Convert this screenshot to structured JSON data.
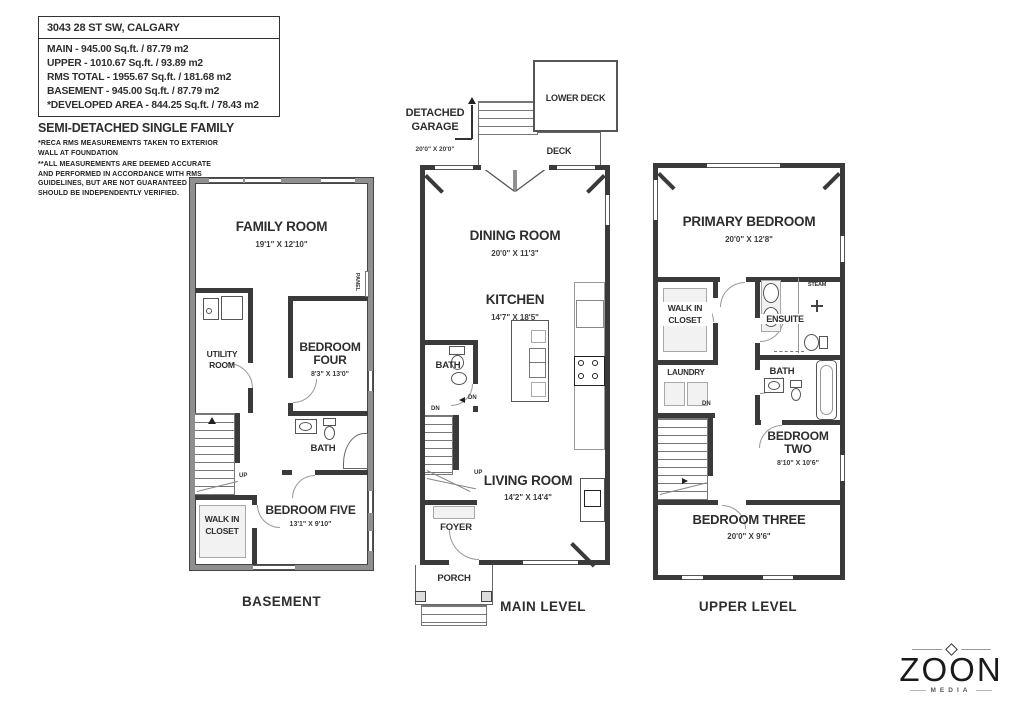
{
  "colors": {
    "wall": "#3a3a3a",
    "foundation": "#8f8f8f",
    "text": "#2e2e2e",
    "logo": "#1a1a1a"
  },
  "header": {
    "address": "3043 28 ST SW, CALGARY",
    "area_lines": [
      "MAIN - 945.00 Sq.ft. / 87.79 m2",
      "UPPER - 1010.67 Sq.ft. / 93.89 m2",
      "RMS TOTAL - 1955.67 Sq.ft. / 181.68 m2",
      "BASEMENT - 945.00 Sq.ft. / 87.79 m2",
      "*DEVELOPED AREA - 844.25 Sq.ft. / 78.43 m2"
    ],
    "property_type": "SEMI-DETACHED SINGLE FAMILY",
    "disclaimer1": "*RECA RMS MEASUREMENTS TAKEN TO EXTERIOR WALL AT FOUNDATION",
    "disclaimer2": "**ALL MEASUREMENTS ARE DEEMED ACCURATE AND PERFORMED IN ACCORDANCE WITH RMS GUIDELINES, BUT ARE NOT GUARANTEED AND SHOULD BE INDEPENDENTLY VERIFIED."
  },
  "basement": {
    "caption": "BASEMENT",
    "family_room": {
      "name": "FAMILY ROOM",
      "dims": "19'1\" X 12'10\""
    },
    "utility_room": {
      "line1": "UTILITY",
      "line2": "ROOM"
    },
    "bedroom_four": {
      "line1": "BEDROOM",
      "line2": "FOUR",
      "dims": "8'3\" X 13'0\""
    },
    "bath": "BATH",
    "bedroom_five": {
      "name": "BEDROOM FIVE",
      "dims": "13'1\" X 9'10\""
    },
    "walk_in_closet": {
      "line1": "WALK IN",
      "line2": "CLOSET"
    },
    "panel": "PANEL",
    "up": "UP"
  },
  "main": {
    "caption": "MAIN LEVEL",
    "detached_garage": {
      "line1": "DETACHED",
      "line2": "GARAGE",
      "dims": "20'0\" X 20'0\""
    },
    "lower_deck": "LOWER DECK",
    "deck": "DECK",
    "dining_room": {
      "name": "DINING ROOM",
      "dims": "20'0\" X 11'3\""
    },
    "kitchen": {
      "name": "KITCHEN",
      "dims": "14'7\" X 18'5\""
    },
    "bath": "BATH",
    "living_room": {
      "name": "LIVING ROOM",
      "dims": "14'2\" X 14'4\""
    },
    "foyer": "FOYER",
    "porch": "PORCH",
    "up": "UP",
    "dn": "DN"
  },
  "upper": {
    "caption": "UPPER LEVEL",
    "primary_bedroom": {
      "name": "PRIMARY BEDROOM",
      "dims": "20'0\" X 12'8\""
    },
    "walk_in_closet": {
      "line1": "WALK IN",
      "line2": "CLOSET"
    },
    "ensuite": "ENSUITE",
    "steam": "STEAM",
    "laundry": "LAUNDRY",
    "bath": "BATH",
    "bedroom_two": {
      "line1": "BEDROOM",
      "line2": "TWO",
      "dims": "8'10\" X 10'6\""
    },
    "bedroom_three": {
      "name": "BEDROOM THREE",
      "dims": "20'0\" X 9'6\""
    },
    "dn": "DN"
  },
  "logo": {
    "brand": "ZOON",
    "subtitle": "MEDIA"
  }
}
